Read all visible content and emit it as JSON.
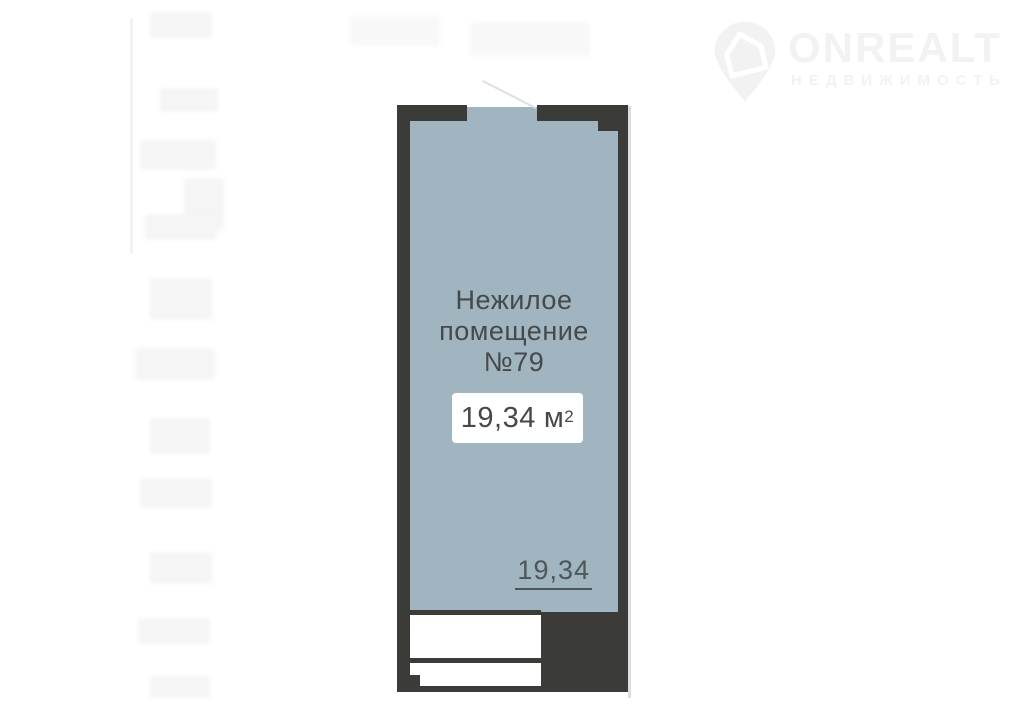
{
  "watermark": {
    "brand": "ONREALT",
    "subtitle": "НЕДВИЖИМОСТЬ",
    "icon": "house-pin-icon"
  },
  "floorplan": {
    "room_label": {
      "line1": "Нежилое",
      "line2": "помещение",
      "line3": "№79"
    },
    "area_badge": {
      "value": "19,34",
      "unit": "м",
      "superscript": "2"
    },
    "dimension_label": "19,34",
    "colors": {
      "wall": "#3b3b37",
      "floor_fill": "#a0b5c0",
      "label_text": "#45494b",
      "dim_text": "#4d565a",
      "watermark": "#f2f2f2",
      "door_line": "#dcdfe0",
      "edge_shadow": "#cfd2d3"
    }
  }
}
